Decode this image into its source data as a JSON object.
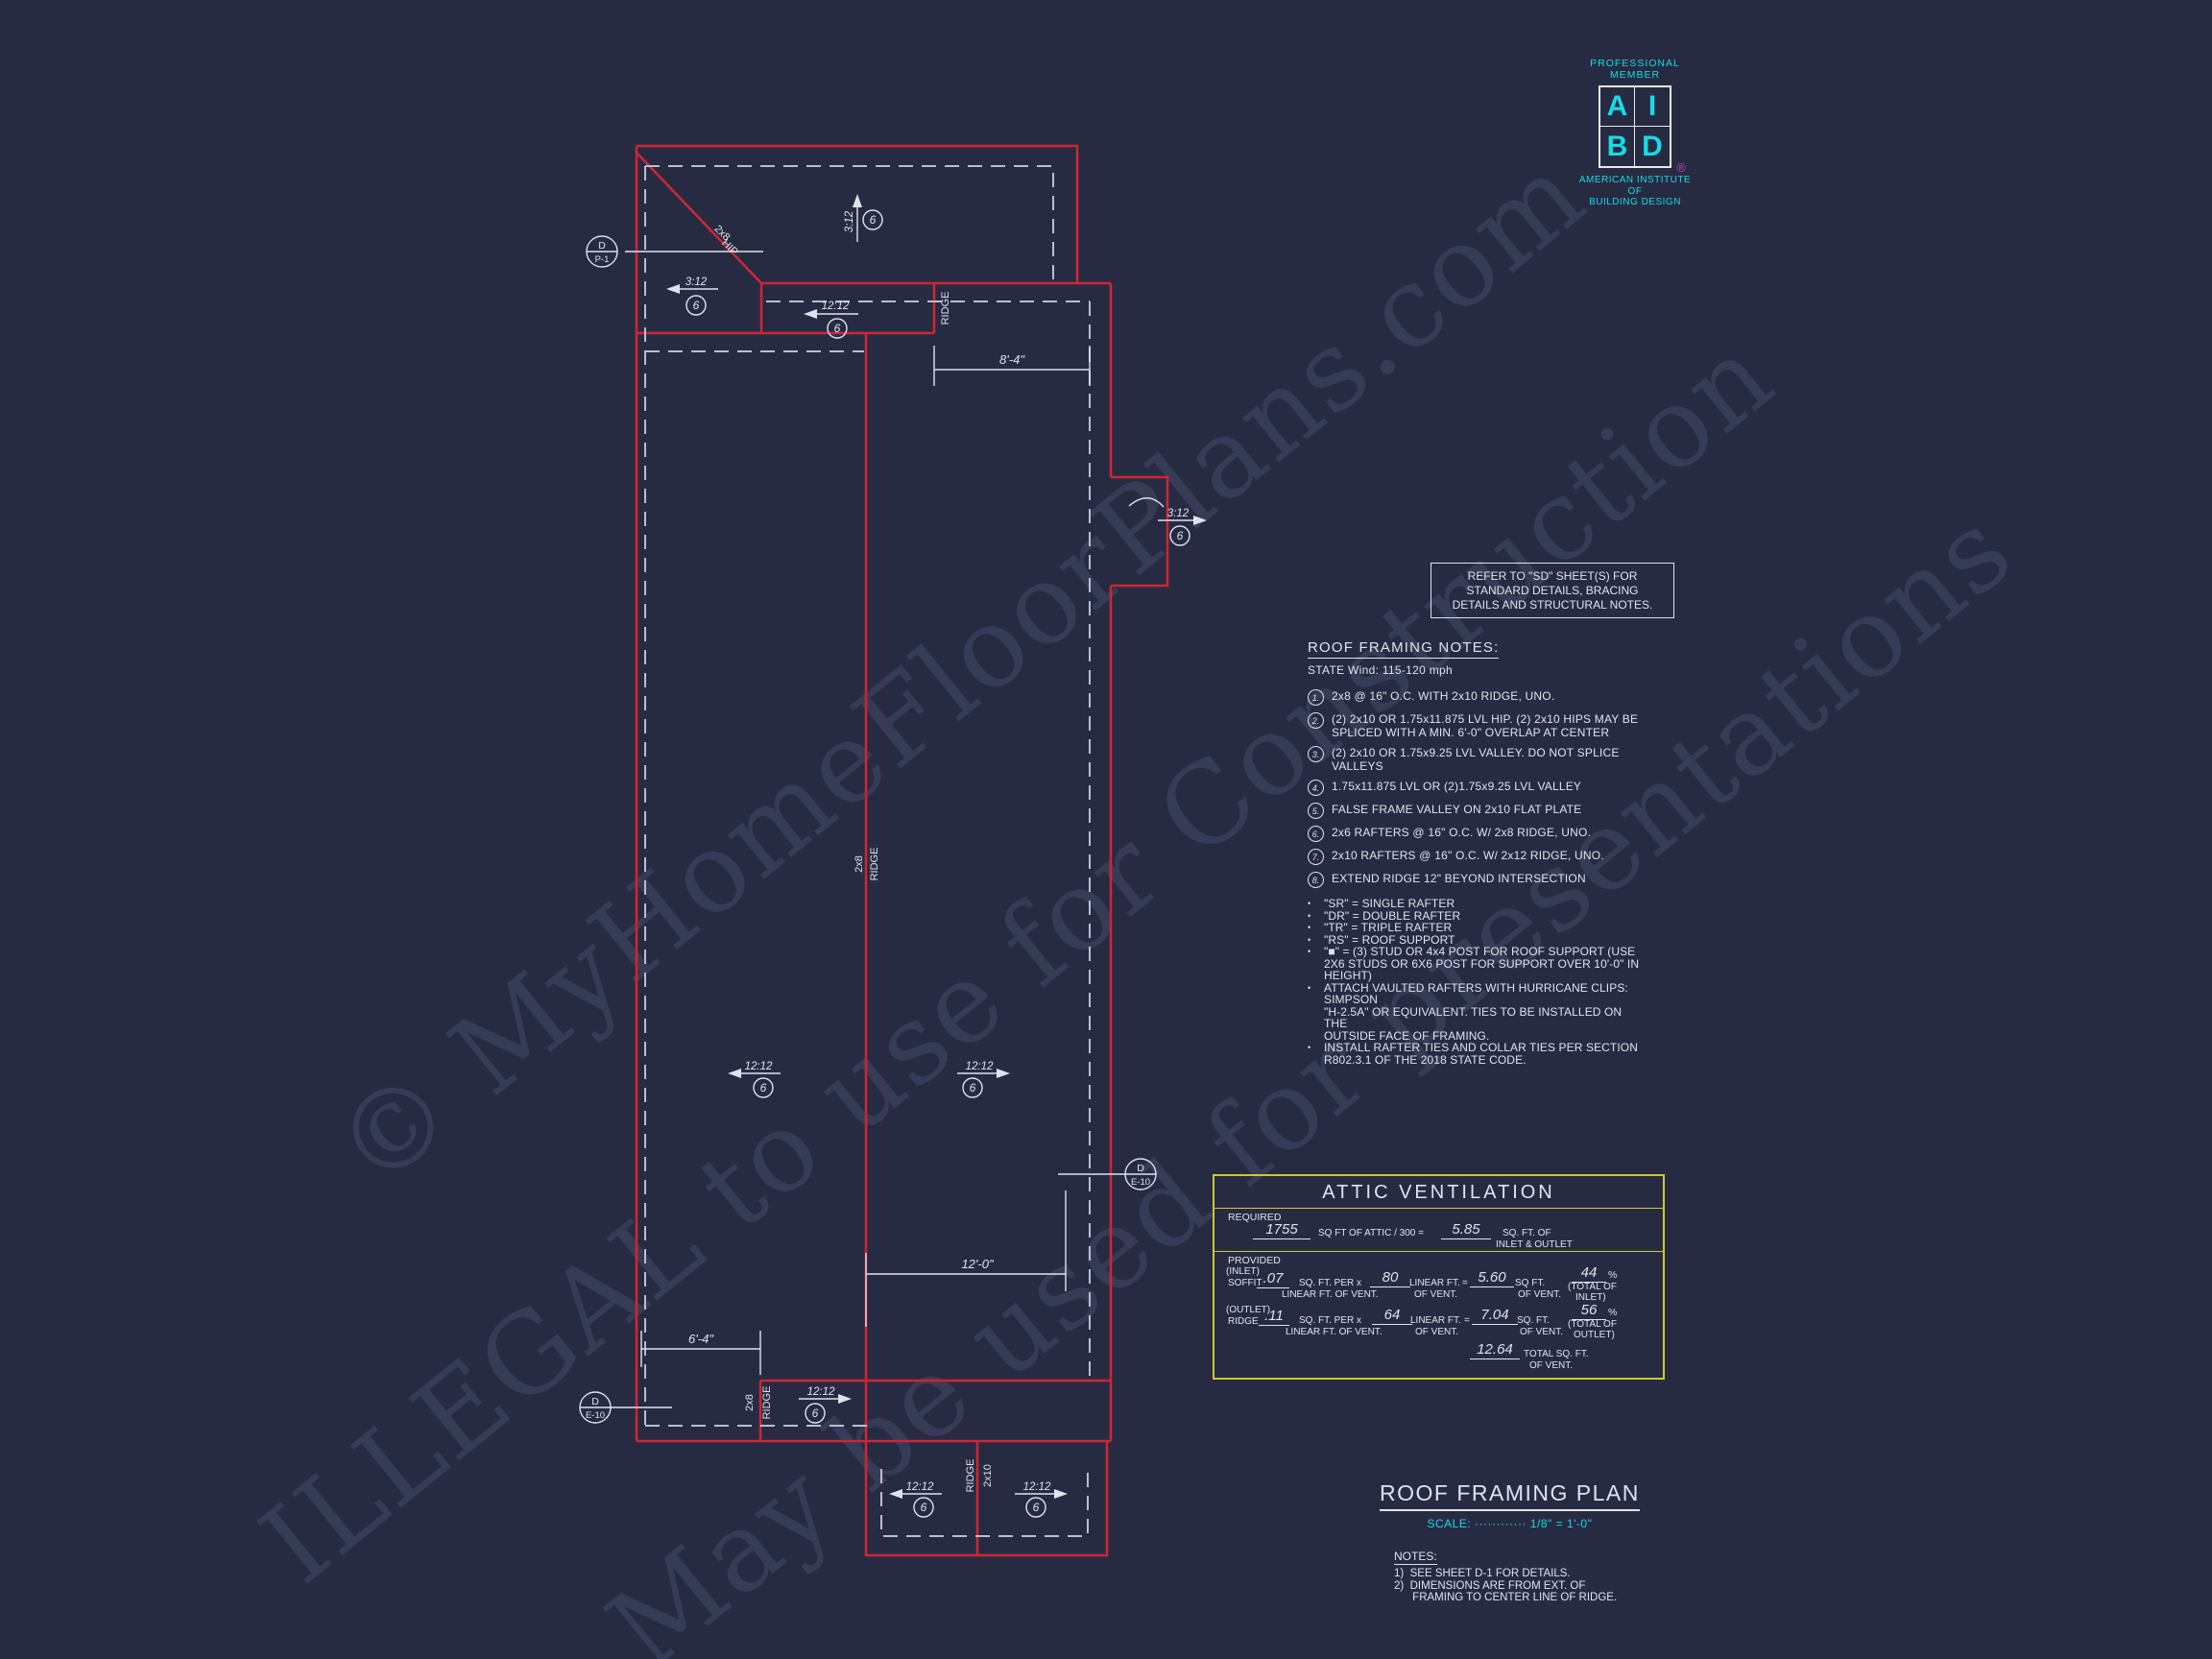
{
  "colors": {
    "background": "#272b42",
    "roof_line_red": "#d02535",
    "overhang_dashed": "#b9bed2",
    "annotation_white": "#dfe3ee",
    "accent_cyan": "#16dbe8",
    "table_yellow": "#c9ca35",
    "registered_magenta": "#c23ac2",
    "watermark_gray": "#8a92b4"
  },
  "watermarks": {
    "w1": "© MyHomeFloorPlans.com",
    "w2": "ILLEGAL to use for Construction",
    "w3": "May be used for presentations"
  },
  "logo": {
    "member_top": "PROFESSIONAL",
    "member_bottom": "MEMBER",
    "a": "A",
    "i": "I",
    "b": "B",
    "d": "D",
    "reg": "®",
    "org1": "AMERICAN INSTITUTE",
    "org2": "OF",
    "org3": "BUILDING DESIGN"
  },
  "sd_note": {
    "text": "REFER TO \"SD\"  SHEET(S) FOR\nSTANDARD DETAILS, BRACING\nDETAILS AND STRUCTURAL NOTES."
  },
  "roof_notes": {
    "title": "ROOF FRAMING NOTES:",
    "subtitle": "STATE Wind:  115-120 mph",
    "bullet_char": "•",
    "numbered": [
      {
        "num": "1.",
        "text": "2x8 @ 16\" O.C. WITH 2x10 RIDGE, UNO."
      },
      {
        "num": "2.",
        "text": "(2) 2x10 OR 1.75x11.875 LVL HIP. (2) 2x10 HIPS MAY BE\nSPLICED WITH A MIN. 6'-0\" OVERLAP AT CENTER"
      },
      {
        "num": "3.",
        "text": "(2) 2x10 OR 1.75x9.25 LVL VALLEY. DO NOT SPLICE\nVALLEYS"
      },
      {
        "num": "4.",
        "text": "1.75x11.875 LVL OR (2)1.75x9.25 LVL VALLEY"
      },
      {
        "num": "5.",
        "text": "FALSE FRAME VALLEY ON 2x10 FLAT PLATE"
      },
      {
        "num": "6.",
        "text": "2x6 RAFTERS @ 16\" O.C. W/ 2x8 RIDGE, UNO."
      },
      {
        "num": "7.",
        "text": "2x10 RAFTERS @ 16\" O.C. W/ 2x12 RIDGE, UNO."
      },
      {
        "num": "8.",
        "text": "EXTEND RIDGE 12\" BEYOND INTERSECTION"
      }
    ],
    "bullets": [
      "\"SR\"  = SINGLE RAFTER",
      "\"DR\" = DOUBLE RAFTER",
      "\"TR\" = TRIPLE RAFTER",
      "\"RS\" = ROOF SUPPORT",
      "\"■\" = (3) STUD OR 4x4 POST FOR ROOF SUPPORT (USE\n2X6 STUDS OR 6X6 POST FOR SUPPORT OVER 10'-0\" IN\nHEIGHT)",
      "ATTACH VAULTED RAFTERS WITH HURRICANE CLIPS:\nSIMPSON\n\"H-2.5A\" OR EQUIVALENT. TIES TO BE INSTALLED ON THE\nOUTSIDE FACE OF FRAMING.",
      "INSTALL RAFTER TIES AND COLLAR TIES PER SECTION\nR802.3.1 OF THE 2018 STATE CODE."
    ]
  },
  "attic": {
    "title": "ATTIC VENTILATION",
    "required": "REQUIRED",
    "req_value": "1755",
    "req_label": "SQ FT OF ATTIC / 300 =",
    "req_result": "5.85",
    "req_unit": "SQ. FT. OF",
    "req_unit2": "INLET & OUTLET",
    "provided": "PROVIDED",
    "inlet_tag": "(INLET)",
    "inlet_name": "SOFFIT",
    "inlet_rate": ".07",
    "rate_unit_top": "SQ. FT. PER x",
    "rate_unit_bottom": "LINEAR FT. OF VENT.",
    "inlet_len": "80",
    "len_unit_top": "LINEAR FT.",
    "len_unit_bottom": "OF VENT.",
    "equals": "=",
    "inlet_result": "5.60",
    "inlet_result_unit_top": "SQ FT.",
    "result_unit_bottom": "OF VENT.",
    "inlet_pct": "44",
    "pct_sign": "%",
    "pct_note_top": "(TOTAL OF",
    "inlet_pct_bottom": "INLET)",
    "outlet_tag": "(OUTLET)",
    "outlet_name": "RIDGE",
    "outlet_rate": ".11",
    "outlet_len": "64",
    "outlet_result": "7.04",
    "outlet_result_unit_top": "SQ. FT.",
    "outlet_pct": "56",
    "outlet_pct_bottom": "OUTLET)",
    "total_value": "12.64",
    "total_label_top": "TOTAL  SQ. FT.",
    "total_label_bottom": "OF VENT."
  },
  "title_block": {
    "title": "ROOF FRAMING PLAN",
    "scale_label": "SCALE:",
    "scale_dots": "············",
    "scale_value": "1/8\" = 1'-0\""
  },
  "bottom_notes": {
    "title": "NOTES:",
    "body": "1)  SEE SHEET D-1 FOR DETAILS.\n2)  DIMENSIONS ARE FROM EXT. OF\n      FRAMING TO CENTER LINE OF RIDGE."
  },
  "plan": {
    "dims": {
      "top": "8'-4\"",
      "bottom_left": "6'-4\"",
      "bottom": "12'-0\""
    },
    "slope_3_12": "3:12",
    "slope_12_12": "12:12",
    "note_ref": "6",
    "marker_d": "D",
    "marker_p1": "P-1",
    "marker_e10": "E-10",
    "label_ridge": "RIDGE",
    "label_2x8": "2x8",
    "label_2x10": "2x10",
    "label_hip": "HIP"
  }
}
